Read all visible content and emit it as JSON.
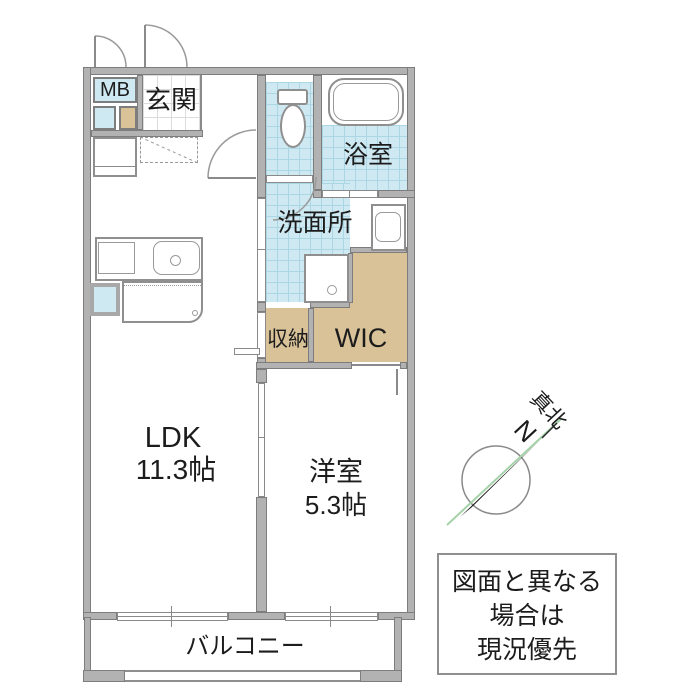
{
  "rooms": {
    "mb": {
      "label": "MB"
    },
    "genkan": {
      "label": "玄関"
    },
    "bath": {
      "label": "浴室"
    },
    "washroom": {
      "label": "洗面所"
    },
    "storage": {
      "label": "収納"
    },
    "wic": {
      "label": "WIC"
    },
    "ldk": {
      "label": "LDK",
      "size": "11.3帖"
    },
    "western": {
      "label": "洋室",
      "size": "5.3帖"
    },
    "balcony": {
      "label": "バルコニー"
    }
  },
  "compass": {
    "true_north": "真北",
    "n": "N"
  },
  "notice": {
    "line1": "図面と異なる",
    "line2": "場合は",
    "line3": "現況優先"
  },
  "colors": {
    "tile_blue": "#cfe9f2",
    "tile_grid": "#abd6e3",
    "closet_tan": "#d9c298",
    "wall_gray": "#b2b2b2",
    "compass_green": "#a5d2a8"
  }
}
